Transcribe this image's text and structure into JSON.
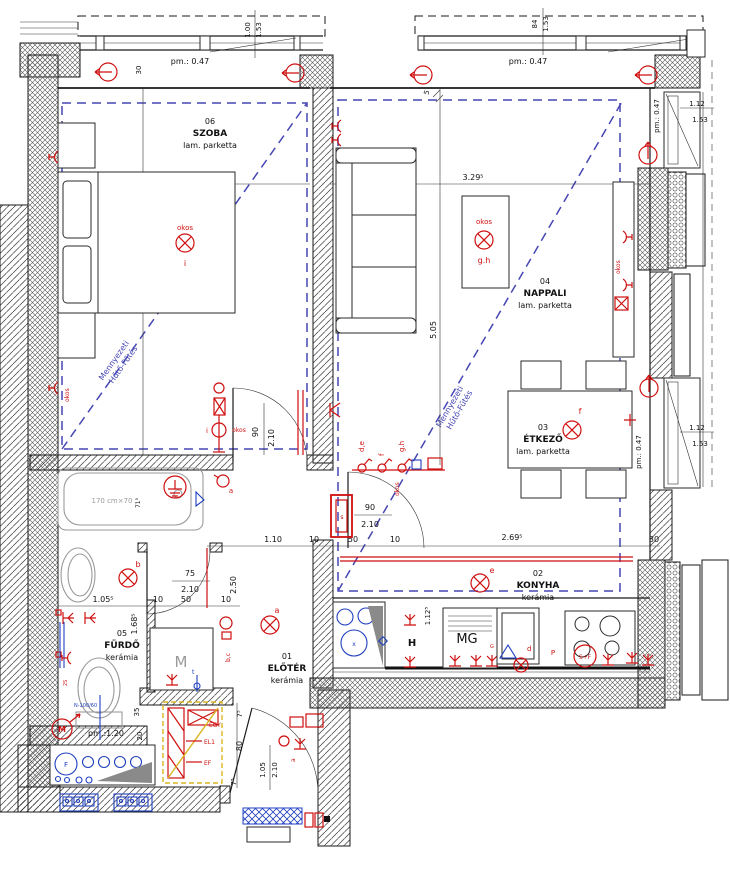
{
  "rooms": {
    "szoba": {
      "number": "06",
      "name": "SZOBA",
      "floor": "lam. parketta",
      "width": "2.93",
      "depth": "4.00",
      "lamp_id": "i"
    },
    "nappali": {
      "number": "04",
      "name": "NAPPALI",
      "floor": "lam. parketta",
      "width": "3.29⁵",
      "depth": "5.05",
      "lamp_id": "g.h"
    },
    "etkezo": {
      "number": "03",
      "name": "ÉTKEZŐ",
      "floor": "lam. parketta",
      "lamp_id": "f"
    },
    "konyha": {
      "number": "02",
      "name": "KONYHA",
      "floor": "kerámia",
      "lamp_id": "e",
      "width": "2.69⁵",
      "counter_depth": "1.12⁵"
    },
    "eloter": {
      "number": "01",
      "name": "ELŐTÉR",
      "floor": "kerámia",
      "lamp_id": "a"
    },
    "furdo": {
      "number": "05",
      "name": "FÜRDŐ",
      "floor": "kerámia",
      "lamp_id": "b",
      "width": "1.05⁵",
      "depth": "1.68⁵",
      "bath_size": "170 cm×70",
      "bath_width": "71⁵",
      "wc_model": "N-100/60",
      "parapet_wc": "pm.:1.20",
      "dim_35": "35",
      "dim_20": "20"
    }
  },
  "ceiling": {
    "line1": "Mennyezeti",
    "line2": "Hűtő-Fűtés"
  },
  "windows": {
    "top_left": {
      "parapet": "pm.: 0.47",
      "size_a": "1.00",
      "size_b": "1.53",
      "wall": "30"
    },
    "top_right": {
      "parapet": "pm.: 0.47",
      "size_a": "84",
      "size_b": "1.53",
      "gap": "5"
    },
    "right_upper": {
      "parapet": "pm.: 0.47",
      "size_a": "1.12",
      "size_b": "1.53"
    },
    "right_lower": {
      "parapet": "pm.: 0.47",
      "size_a": "1.12",
      "size_b": "1.53"
    },
    "kitchen_wall": "30"
  },
  "doors": {
    "szoba": {
      "w": "90",
      "h": "2.10"
    },
    "nappali": {
      "w": "90",
      "h": "2.10",
      "tag": "s"
    },
    "furdo": {
      "w": "75",
      "h": "2.10"
    },
    "entrance": {
      "w": "1.05",
      "h": "2.10",
      "niche": "80",
      "jamb_a": "7⁵",
      "jamb_b": "7⁵"
    }
  },
  "corridor": {
    "width": "1.10",
    "wall": "10",
    "length": "2.50",
    "seg_a": "10",
    "seg_b": "50",
    "seg_c": "10"
  },
  "kitchen": {
    "seg_a": "50",
    "seg_b": "10",
    "mg": "MG",
    "h": "H",
    "sf": "S+F",
    "p": "P",
    "d": "d",
    "g": "G"
  },
  "electrical": {
    "smart": "okos",
    "sw_de": "d,e",
    "sw_f": "f",
    "sw_gh": "g.h",
    "socket_a": "a",
    "socket_bc": "b,c",
    "tag_2s": "2S",
    "meter": "M",
    "washer": "M",
    "washer_t": "t",
    "entry_a": "a",
    "panel": {
      "egy": "EGY",
      "el1": "EL1",
      "ef": "EF"
    }
  },
  "colors": {
    "red": "#cf0f0f",
    "blue": "#1f3fbf",
    "ceiling_blue": "#4646b4",
    "panel_yellow": "#d9b520"
  }
}
